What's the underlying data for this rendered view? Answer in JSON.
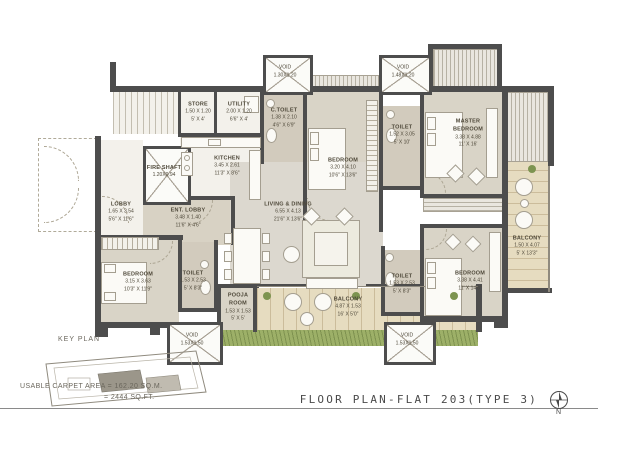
{
  "rooms": {
    "store": {
      "name": "STORE",
      "dim_m": "1.50 X 1.20",
      "dim_ft": "5' X 4'"
    },
    "utility": {
      "name": "UTILITY",
      "dim_m": "2.00 X 1.20",
      "dim_ft": "6'6\" X 4'"
    },
    "kitchen": {
      "name": "KITCHEN",
      "dim_m": "3.45 X 2.61",
      "dim_ft": "11'3\" X 8'6\""
    },
    "fire_shaft": {
      "name": "FIRE SHAFT",
      "dim_m": "1.20X0.94"
    },
    "lobby": {
      "name": "LOBBY",
      "dim_m": "1.65 X 3.54",
      "dim_ft": "5'6\" X 11'6\""
    },
    "ent_lobby": {
      "name": "ENT. LOBBY",
      "dim_m": "3.48 X 1.40",
      "dim_ft": "11'6\" X 4'6\""
    },
    "c_toilet": {
      "name": "C.TOILET",
      "dim_m": "1.38 X 2.10",
      "dim_ft": "4'6\" X 6'9\""
    },
    "bedroom_top": {
      "name": "BEDROOM",
      "dim_m": "3.20 X 4.10",
      "dim_ft": "10'6\" X 13'6\""
    },
    "toilet_top": {
      "name": "TOILET",
      "dim_m": "1.52 X 3.05",
      "dim_ft": "5' X 10'"
    },
    "master_bedroom": {
      "name": "MASTER BEDROOM",
      "dim_m": "3.38 X 4.88",
      "dim_ft": "11' X 16'"
    },
    "living_dining": {
      "name": "LIVING & DINING",
      "dim_m": "6.55 X 4.13",
      "dim_ft": "21'6\" X 13'6\""
    },
    "bedroom_left": {
      "name": "BEDROOM",
      "dim_m": "3.15 X 3.63",
      "dim_ft": "10'3\" X 11'9\""
    },
    "toilet_left": {
      "name": "TOILET",
      "dim_m": "1.53 X 2.53",
      "dim_ft": "5' X 8'3\""
    },
    "pooja_room": {
      "name": "POOJA ROOM",
      "dim_m": "1.53 X 1.53",
      "dim_ft": "5' X 5'"
    },
    "balcony_bottom": {
      "name": "BALCONY",
      "dim_m": "4.87 X 1.53",
      "dim_ft": "16' X 5'0\""
    },
    "toilet_right": {
      "name": "TOILET",
      "dim_m": "1.53 X 2.53",
      "dim_ft": "5' X 8'3\""
    },
    "bedroom_right": {
      "name": "BEDROOM",
      "dim_m": "3.38 X 4.41",
      "dim_ft": "11' X 14'6\""
    },
    "balcony_right": {
      "name": "BALCONY",
      "dim_m": "1.50 X 4.07",
      "dim_ft": "5' X 13'3\""
    },
    "void_top_left": {
      "name": "VOID",
      "dim_m": "1.30X1.20"
    },
    "void_top_right": {
      "name": "VOID",
      "dim_m": "1.48X1.20"
    },
    "void_bottom_left": {
      "name": "VOID",
      "dim_m": "1.53X1.50"
    },
    "void_bottom_right": {
      "name": "VOID",
      "dim_m": "1.53X1.50"
    }
  },
  "key_plan": {
    "label": "KEY PLAN",
    "area_line1": "USABLE CARPET AREA = 162.20 SQ.M.",
    "area_line2": "= 2444 SQ.FT."
  },
  "title_block": {
    "title": "FLOOR PLAN-FLAT 203(TYPE 3)",
    "north_label": "N"
  },
  "colors": {
    "wall": "#4d4d4d",
    "bedroom_fill": "#d9d4c7",
    "toilet_fill": "#d2cbbd",
    "living_fill": "#dcd8cf",
    "wood_fill": "#e6dcc0",
    "grass_fill": "#9db068"
  }
}
